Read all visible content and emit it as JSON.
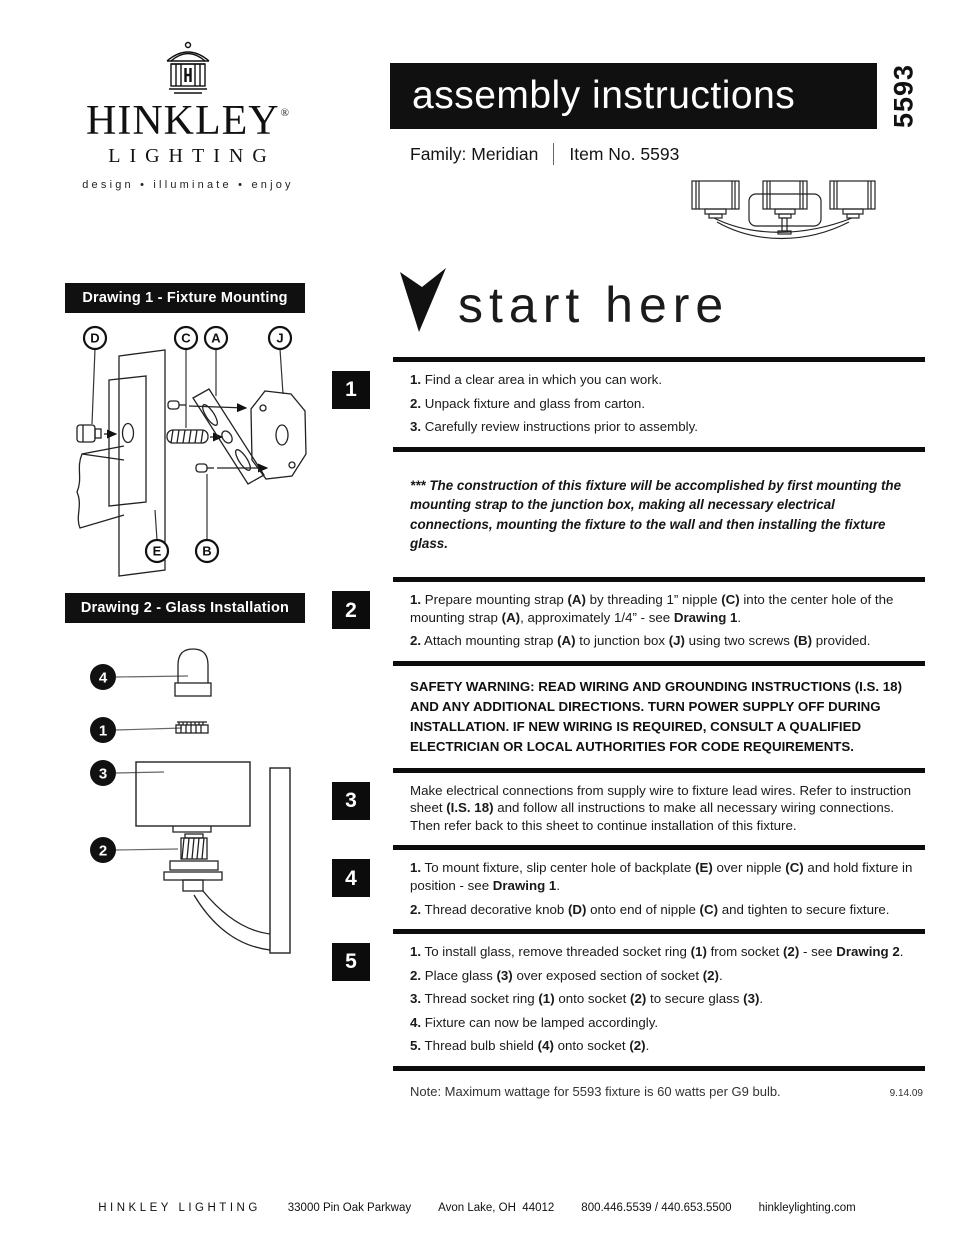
{
  "colors": {
    "ink": "#111111",
    "paper": "#ffffff"
  },
  "brand": {
    "name": "HINKLEY",
    "registered": "®",
    "sub": "LIGHTING",
    "tagline": "design • illuminate • enjoy"
  },
  "header": {
    "title": "assembly instructions",
    "item_vertical": "5593",
    "family_label": "Family: Meridian",
    "item_label": "Item No. 5593"
  },
  "start": {
    "text": "start here"
  },
  "drawings": {
    "d1_title": "Drawing 1 - Fixture Mounting",
    "d2_title": "Drawing 2 - Glass Installation",
    "d1_callouts": [
      "D",
      "C",
      "A",
      "J",
      "E",
      "B"
    ],
    "d2_callouts": [
      "4",
      "1",
      "3",
      "2"
    ]
  },
  "instructions": {
    "step1": {
      "num": "1",
      "lines": [
        [
          {
            "b": true,
            "t": "1."
          },
          {
            "t": " Find a clear area in which you can work."
          }
        ],
        [
          {
            "b": true,
            "t": "2."
          },
          {
            "t": " Unpack fixture and glass from carton."
          }
        ],
        [
          {
            "b": true,
            "t": "3."
          },
          {
            "t": " Carefully review instructions prior to assembly."
          }
        ]
      ]
    },
    "construction_note": "*** The construction of this fixture will be accomplished by first mounting the mounting strap to the junction box, making all necessary electrical connections, mounting the fixture to the wall and then installing the fixture glass.",
    "step2": {
      "num": "2",
      "lines": [
        [
          {
            "b": true,
            "t": "1."
          },
          {
            "t": " Prepare mounting strap "
          },
          {
            "b": true,
            "t": "(A)"
          },
          {
            "t": " by threading 1” nipple "
          },
          {
            "b": true,
            "t": "(C)"
          },
          {
            "t": " into the center hole of the mounting strap "
          },
          {
            "b": true,
            "t": "(A)"
          },
          {
            "t": ", approximately 1/4” - see "
          },
          {
            "b": true,
            "t": "Drawing 1"
          },
          {
            "t": "."
          }
        ],
        [
          {
            "b": true,
            "t": "2."
          },
          {
            "t": " Attach mounting strap "
          },
          {
            "b": true,
            "t": "(A)"
          },
          {
            "t": " to junction box "
          },
          {
            "b": true,
            "t": "(J)"
          },
          {
            "t": " using two screws "
          },
          {
            "b": true,
            "t": "(B)"
          },
          {
            "t": " provided."
          }
        ]
      ]
    },
    "safety_warning": "SAFETY WARNING: READ WIRING AND GROUNDING INSTRUCTIONS (I.S. 18) AND ANY ADDITIONAL DIRECTIONS. TURN POWER SUPPLY OFF DURING INSTALLATION. IF NEW WIRING IS REQUIRED, CONSULT A QUALIFIED ELECTRICIAN OR LOCAL AUTHORITIES FOR CODE REQUIREMENTS.",
    "step3": {
      "num": "3",
      "lines": [
        [
          {
            "t": "Make electrical connections from supply wire to fixture lead wires. Refer to instruction sheet "
          },
          {
            "b": true,
            "t": "(I.S. 18)"
          },
          {
            "t": " and follow all instructions to make all necessary wiring connections. Then refer back to this sheet to continue installation of this fixture."
          }
        ]
      ]
    },
    "step4": {
      "num": "4",
      "lines": [
        [
          {
            "b": true,
            "t": "1."
          },
          {
            "t": " To mount fixture, slip center hole of backplate "
          },
          {
            "b": true,
            "t": "(E)"
          },
          {
            "t": " over nipple "
          },
          {
            "b": true,
            "t": "(C)"
          },
          {
            "t": " and hold fixture in position - see "
          },
          {
            "b": true,
            "t": "Drawing 1"
          },
          {
            "t": "."
          }
        ],
        [
          {
            "b": true,
            "t": "2."
          },
          {
            "t": " Thread decorative knob "
          },
          {
            "b": true,
            "t": "(D)"
          },
          {
            "t": " onto end of nipple "
          },
          {
            "b": true,
            "t": "(C)"
          },
          {
            "t": " and tighten to secure fixture."
          }
        ]
      ]
    },
    "step5": {
      "num": "5",
      "lines": [
        [
          {
            "b": true,
            "t": "1."
          },
          {
            "t": " To install glass, remove threaded socket ring "
          },
          {
            "b": true,
            "t": "(1)"
          },
          {
            "t": " from socket "
          },
          {
            "b": true,
            "t": "(2)"
          },
          {
            "t": " - see "
          },
          {
            "b": true,
            "t": "Drawing 2"
          },
          {
            "t": "."
          }
        ],
        [
          {
            "b": true,
            "t": "2."
          },
          {
            "t": " Place glass "
          },
          {
            "b": true,
            "t": "(3)"
          },
          {
            "t": " over exposed section of socket "
          },
          {
            "b": true,
            "t": "(2)"
          },
          {
            "t": "."
          }
        ],
        [
          {
            "b": true,
            "t": "3."
          },
          {
            "t": " Thread socket ring "
          },
          {
            "b": true,
            "t": "(1)"
          },
          {
            "t": " onto socket "
          },
          {
            "b": true,
            "t": "(2)"
          },
          {
            "t": " to secure glass "
          },
          {
            "b": true,
            "t": "(3)"
          },
          {
            "t": "."
          }
        ],
        [
          {
            "b": true,
            "t": "4."
          },
          {
            "t": " Fixture can now be lamped accordingly."
          }
        ],
        [
          {
            "b": true,
            "t": "5."
          },
          {
            "t": " Thread bulb shield "
          },
          {
            "b": true,
            "t": "(4)"
          },
          {
            "t": " onto socket "
          },
          {
            "b": true,
            "t": "(2)"
          },
          {
            "t": "."
          }
        ]
      ]
    },
    "max_wattage_note": "Note: Maximum wattage for 5593 fixture is 60 watts per G9 bulb.",
    "revision_date": "9.14.09"
  },
  "footer": {
    "brand": "HINKLEY LIGHTING",
    "address": "33000 Pin Oak Parkway",
    "city": "Avon Lake, OH  44012",
    "phone": "800.446.5539 / 440.653.5500",
    "website": "hinkleylighting.com"
  }
}
